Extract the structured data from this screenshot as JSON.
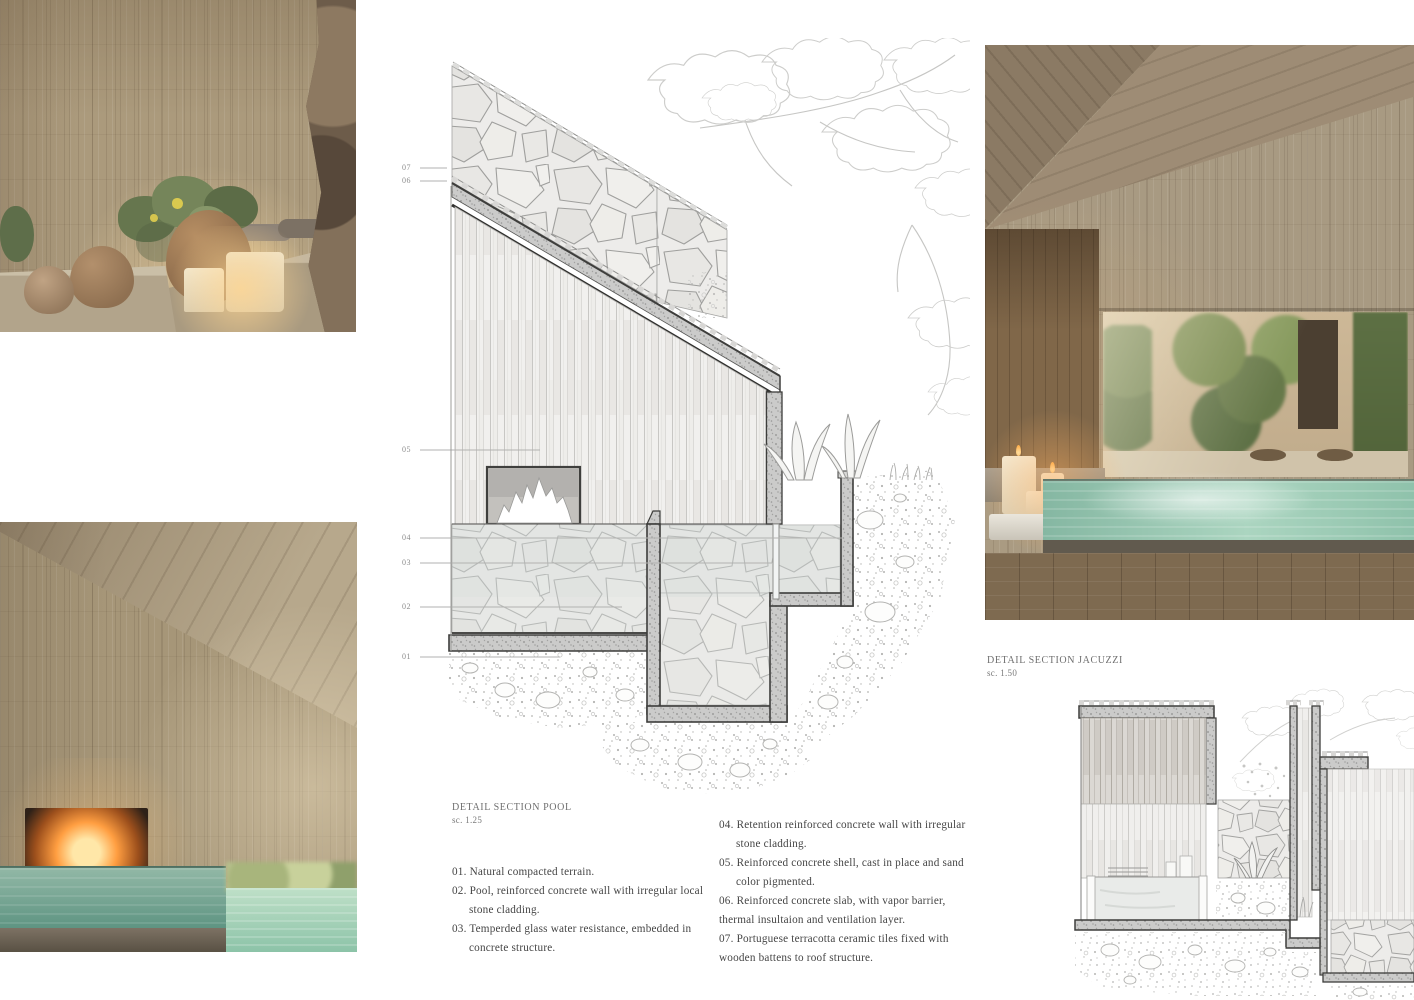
{
  "drawing_pool": {
    "title": "DETAIL SECTION POOL",
    "scale": "sc. 1.25",
    "callouts": [
      "07",
      "06",
      "05",
      "04",
      "03",
      "02",
      "01"
    ]
  },
  "drawing_jacuzzi": {
    "title": "DETAIL SECTION JACUZZI",
    "scale": "sc. 1.50"
  },
  "notes": {
    "col1": [
      {
        "text": "01. Natural compacted terrain."
      },
      {
        "text": "02. Pool, reinforced concrete wall with irregular local"
      },
      {
        "text": "stone cladding."
      },
      {
        "text": "03. Temperded glass water resistance, embedded in"
      },
      {
        "text": "concrete structure."
      }
    ],
    "col2": [
      {
        "text": "04. Retention reinforced concrete wall with irregular"
      },
      {
        "text": "stone cladding."
      },
      {
        "text": "05. Reinforced concrete shell, cast in place and sand"
      },
      {
        "text": "color pigmented."
      },
      {
        "text": "06. Reinforced concrete slab, with vapor barrier,"
      },
      {
        "text": "thermal insultaion and ventilation layer."
      },
      {
        "text": "07. Portuguese terracotta ceramic tiles fixed with"
      },
      {
        "text": "wooden battens to roof structure."
      }
    ]
  },
  "palette": {
    "water_teal": "#7fb4a0",
    "wood_tan": "#ab9a7c",
    "line_gray": "#9a9a98",
    "concrete_gray": "#cccccb",
    "text_gray": "#454545"
  }
}
